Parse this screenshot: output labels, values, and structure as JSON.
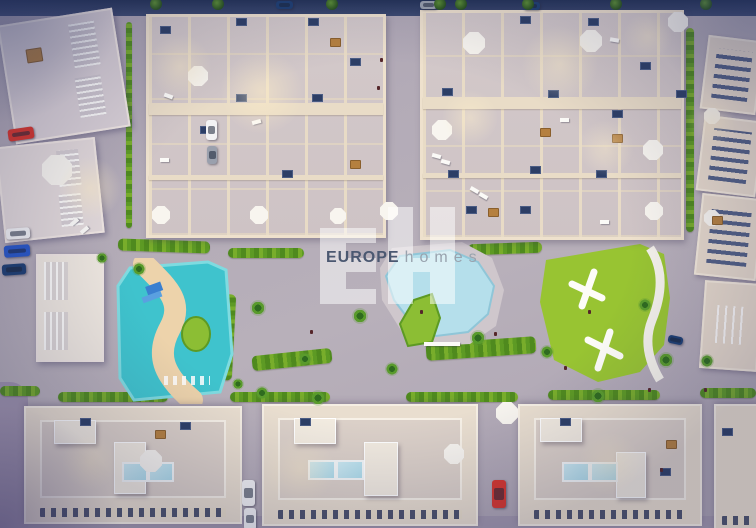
{
  "watermark": {
    "logo_letters": "EH",
    "brand": "EUROPE",
    "brand_suffix": "homes"
  },
  "palette": {
    "street": "#b1a9b5",
    "street_top_dark": "#2c3a5e",
    "roof_floor": "#d0c5c6",
    "building_wall_cream": "#ecdfca",
    "building_block_cream": "#e9decf",
    "lawn_green": "#9ac233",
    "hedge_green": "#4f8a1e",
    "lagoon_water": "#3fc3cd",
    "lagoon_sand": "#edd3ab",
    "central_pool_water": "#b5dfeb",
    "rooftop_pool": "#aedcea",
    "umbrella_white": "#f8f5ef",
    "car_red": "#d6352c",
    "car_blue": "#2857c8",
    "car_white": "#f2f2f4",
    "watermark_fill": "rgba(255,255,255,0.52)",
    "brand_text_color": "#4b5871",
    "brand_suffix_color": "#99a3ae"
  }
}
